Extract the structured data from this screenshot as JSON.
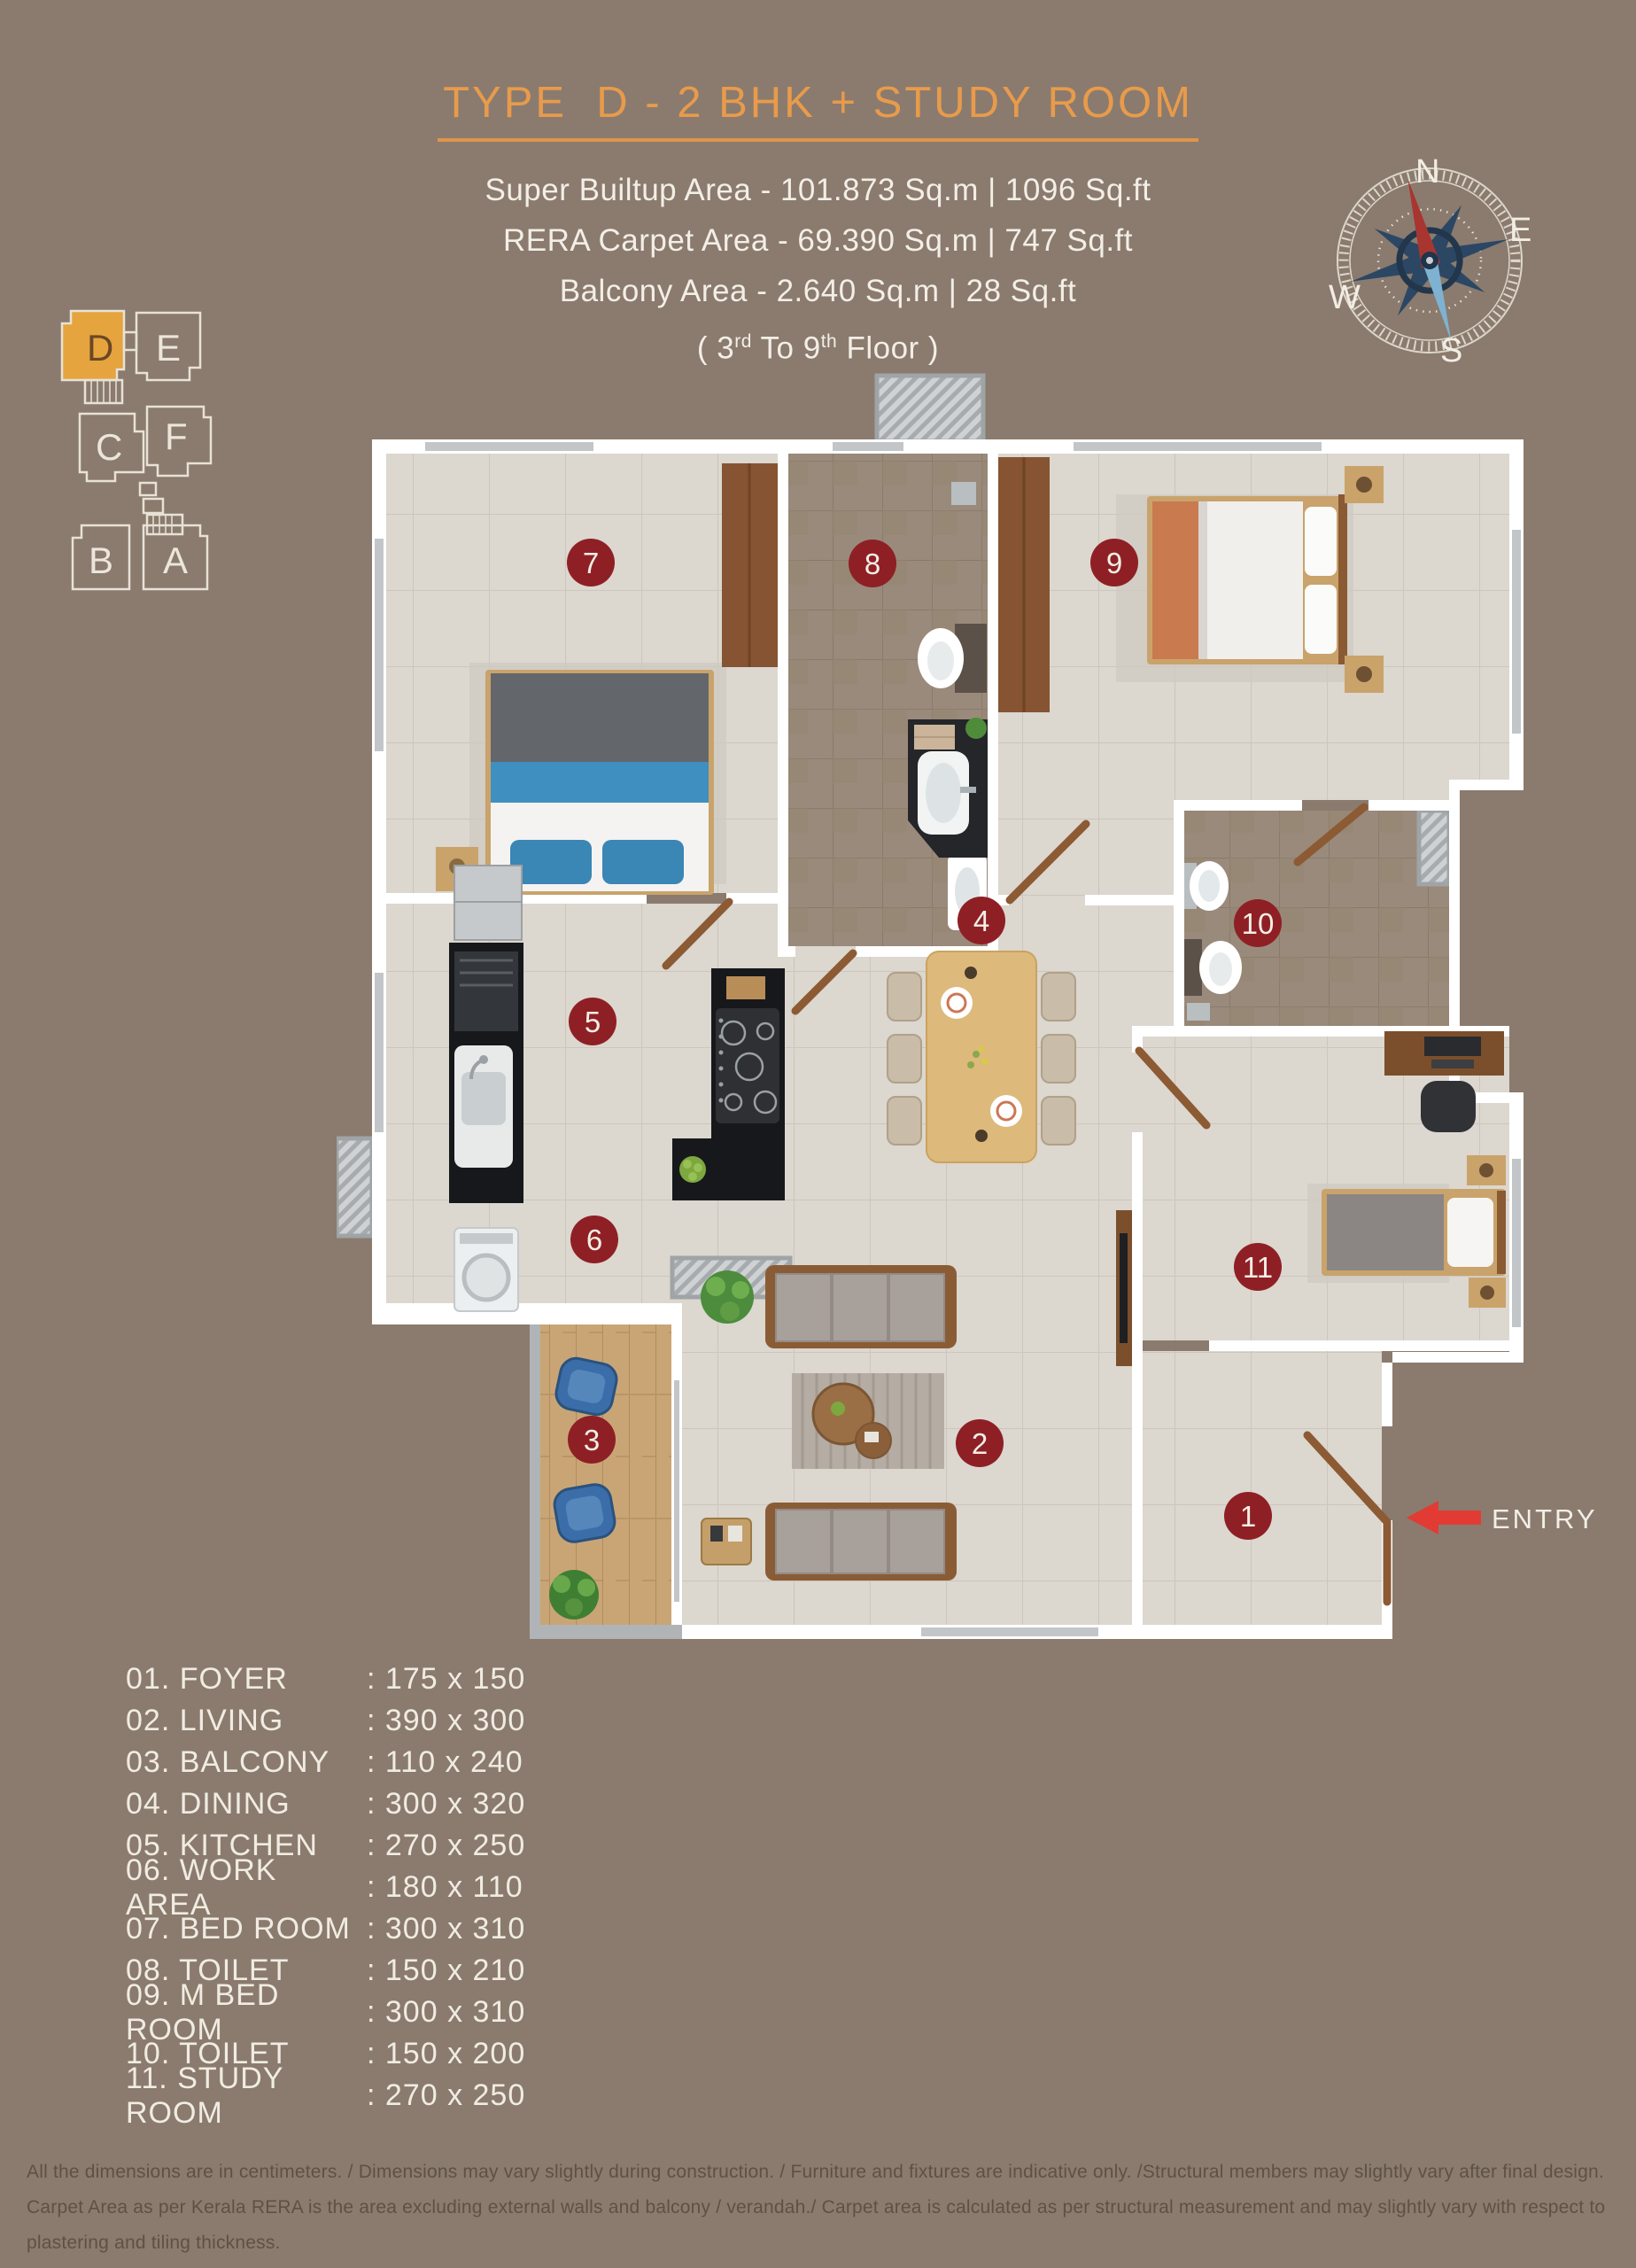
{
  "colors": {
    "background": "#8a7b6e",
    "accent_orange": "#e89b4b",
    "text_cream": "#f3eee6",
    "badge_red": "#8e2025",
    "entry_arrow_red": "#e23b34",
    "highlight_unit_fill": "#e6a43e",
    "toilet_tile": "#9a8a7b",
    "balcony_wood": "#c9a576"
  },
  "header": {
    "title": "TYPE  D - 2 BHK + STUDY ROOM",
    "line1": "Super Builtup  Area - 101.873 Sq.m | 1096 Sq.ft",
    "line2": "RERA Carpet Area - 69.390 Sq.m | 747 Sq.ft",
    "line3": "Balcony Area - 2.640 Sq.m | 28 Sq.ft",
    "floor": {
      "pre": "( 3",
      "sup1": "rd",
      "mid": " To 9",
      "sup2": "th",
      "post": " Floor )"
    }
  },
  "compass": {
    "n": "N",
    "e": "E",
    "s": "S",
    "w": "W"
  },
  "blocks": {
    "a": "A",
    "b": "B",
    "c": "C",
    "d": "D",
    "e": "E",
    "f": "F"
  },
  "plan": {
    "entry_label": "ENTRY",
    "badges": [
      "1",
      "2",
      "3",
      "4",
      "5",
      "6",
      "7",
      "8",
      "9",
      "10",
      "11"
    ]
  },
  "legend": {
    "rows": [
      {
        "label": "01. FOYER",
        "dims": ": 175 x 150"
      },
      {
        "label": "02. LIVING",
        "dims": ": 390 x 300"
      },
      {
        "label": "03. BALCONY",
        "dims": ": 110 x 240"
      },
      {
        "label": "04. DINING",
        "dims": ": 300 x 320"
      },
      {
        "label": "05. KITCHEN",
        "dims": ": 270 x 250"
      },
      {
        "label": "06. WORK AREA",
        "dims": ": 180 x 110"
      },
      {
        "label": "07. BED ROOM",
        "dims": ": 300 x 310"
      },
      {
        "label": "08. TOILET",
        "dims": ": 150 x 210"
      },
      {
        "label": "09. M BED ROOM",
        "dims": ": 300 x 310"
      },
      {
        "label": "10. TOILET",
        "dims": ": 150 x 200"
      },
      {
        "label": "11. STUDY ROOM",
        "dims": ": 270 x 250"
      }
    ]
  },
  "disclaimer": {
    "line1": "All the dimensions are in centimeters. / Dimensions may vary slightly during construction. / Furniture and fixtures are indicative only. /Structural members may slightly vary after final design.",
    "line2": "Carpet Area as per Kerala  RERA is the area excluding external walls and balcony / verandah./ Carpet area is calculated as per structural measurement  and may slightly vary with respect to plastering and tiling thickness."
  }
}
